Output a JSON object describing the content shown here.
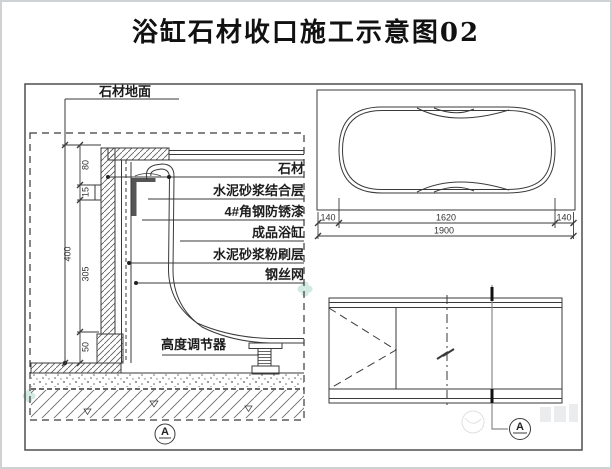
{
  "title": "浴缸石材收口施工示意图02",
  "left_detail": {
    "labels": {
      "stone_floor": "石材地面",
      "stone": "石材",
      "cement_mortar_bonding_layer": "水泥砂浆结合层",
      "angle_steel_rustproof_paint": "4#角钢防锈漆",
      "finished_bathtub": "成品浴缸",
      "cement_mortar_plaster_layer": "水泥砂浆粉刷层",
      "steel_wire_mesh": "钢丝网",
      "height_adjuster": "高度调节器"
    },
    "dimensions": {
      "seg_top": "80",
      "seg_notch": "15",
      "seg_mid": "305",
      "seg_bottom": "50",
      "total": "400"
    },
    "section_marker": "A"
  },
  "plan_view": {
    "dimensions": {
      "left_margin": "140",
      "tub_length": "1620",
      "right_margin": "140",
      "total": "1900"
    }
  },
  "side_view": {
    "section_marker": "A"
  },
  "colors": {
    "line": "#3a3a3a",
    "light_line": "#8a8a8a",
    "watermark_green": "#aed9cc",
    "watermark_gray": "#c3c8cd"
  }
}
